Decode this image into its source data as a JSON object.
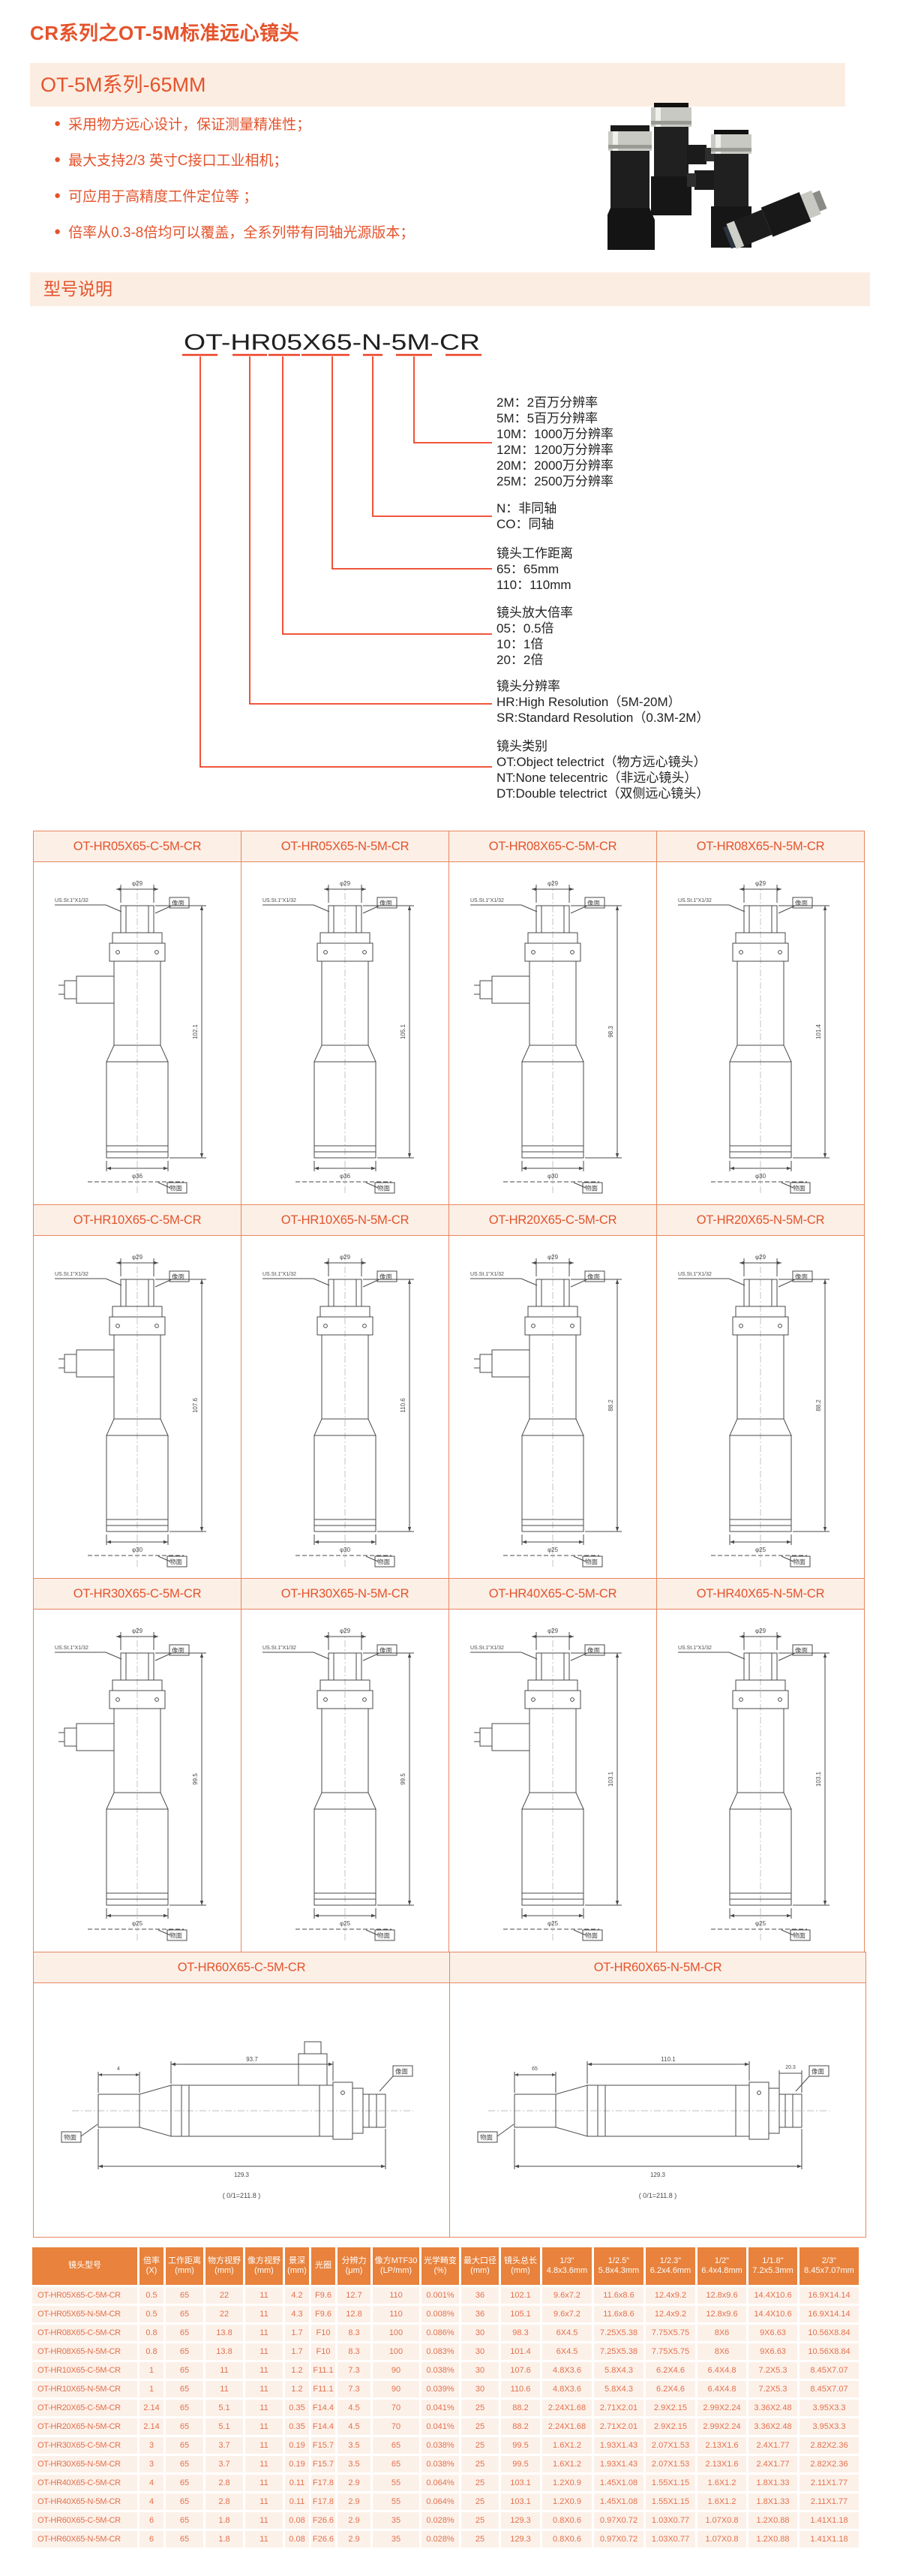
{
  "colors": {
    "accent": "#E4532C",
    "band_bg": "#FCEDE2",
    "callout": "#EE3F22",
    "grid_border": "#E8875F",
    "grid_title_bg": "#FBEFE6",
    "table_header_bg": "#E8823C",
    "table_cell_bg": "#FCF1E9",
    "table_cell_text": "#E2714E",
    "drawing_ink": "#4A4A4A"
  },
  "header": {
    "title": "CR系列之OT-5M标准远心镜头",
    "series_badge": "OT-5M系列-65MM",
    "bullets": [
      "采用物方远心设计，保证测量精准性；",
      "最大支持2/3 英寸C接口工业相机；",
      "可应用于高精度工件定位等 ；",
      "倍率从0.3-8倍均可以覆盖，全系列带有同轴光源版本；"
    ]
  },
  "model_section": {
    "badge": "型号说明",
    "model": "OT-HR05X65-N-5M-CR",
    "groups": [
      {
        "heading": "",
        "lines": [
          "2M：2百万分辨率",
          "5M：5百万分辨率",
          "10M：1000万分辨率",
          "12M：1200万分辨率",
          "20M：2000万分辨率",
          "25M：2500万分辨率"
        ]
      },
      {
        "heading": "",
        "lines": [
          "N：非同轴",
          "CO：同轴"
        ]
      },
      {
        "heading": "镜头工作距离",
        "lines": [
          "65：65mm",
          "110：110mm"
        ]
      },
      {
        "heading": "镜头放大倍率",
        "lines": [
          "05：0.5倍",
          "10：1倍",
          "20：2倍"
        ]
      },
      {
        "heading": "镜头分辨率",
        "lines": [
          "HR:High Resolution（5M-20M）",
          "SR:Standard Resolution（0.3M-2M）"
        ]
      },
      {
        "heading": "镜头类别",
        "lines": [
          "OT:Object telectrict（物方远心镜头）",
          "NT:None telecentric（非远心镜头）",
          "DT:Double telectrict（双侧远心镜头）"
        ]
      }
    ]
  },
  "drawings": {
    "labels": {
      "top_dia": "φ29",
      "thread": "US.St.1\"X1/32",
      "image_plane": "像面",
      "object_plane": "物面"
    },
    "cells": [
      {
        "title": "OT-HR05X65-C-5M-CR",
        "type": "c",
        "dia": "φ36",
        "len": "102.1"
      },
      {
        "title": "OT-HR05X65-N-5M-CR",
        "type": "n",
        "dia": "φ36",
        "len": "105.1"
      },
      {
        "title": "OT-HR08X65-C-5M-CR",
        "type": "c",
        "dia": "φ30",
        "len": "98.3"
      },
      {
        "title": "OT-HR08X65-N-5M-CR",
        "type": "n",
        "dia": "φ30",
        "len": "101.4"
      },
      {
        "title": "OT-HR10X65-C-5M-CR",
        "type": "c",
        "dia": "φ30",
        "len": "107.6"
      },
      {
        "title": "OT-HR10X65-N-5M-CR",
        "type": "n",
        "dia": "φ30",
        "len": "110.6"
      },
      {
        "title": "OT-HR20X65-C-5M-CR",
        "type": "c",
        "dia": "φ25",
        "len": "88.2"
      },
      {
        "title": "OT-HR20X65-N-5M-CR",
        "type": "n",
        "dia": "φ25",
        "len": "88.2"
      },
      {
        "title": "OT-HR30X65-C-5M-CR",
        "type": "c",
        "dia": "φ25",
        "len": "99.5"
      },
      {
        "title": "OT-HR30X65-N-5M-CR",
        "type": "n",
        "dia": "φ25",
        "len": "99.5"
      },
      {
        "title": "OT-HR40X65-C-5M-CR",
        "type": "c",
        "dia": "φ25",
        "len": "103.1"
      },
      {
        "title": "OT-HR40X65-N-5M-CR",
        "type": "n",
        "dia": "φ25",
        "len": "103.1"
      }
    ],
    "wide_cells": [
      {
        "title": "OT-HR60X65-C-5M-CR",
        "type": "c",
        "left": "4",
        "top": "93.7",
        "right": "",
        "len": "129.3",
        "total": "( 0/1=211.8 )"
      },
      {
        "title": "OT-HR60X65-N-5M-CR",
        "type": "n",
        "left": "65",
        "top": "110.1",
        "right": "20.3",
        "len": "129.3",
        "total": "( 0/1=211.8 )"
      }
    ]
  },
  "table": {
    "headers": [
      "镜头型号",
      "倍率\n(X)",
      "工作距离\n(mm)",
      "物方视野\n(mm)",
      "像方视野\n(mm)",
      "景深\n(mm)",
      "光圈",
      "分辨力\n(μm)",
      "像方MTF30\n(LP/mm)",
      "光学畸变\n(%)",
      "最大口径\n(mm)",
      "镜头总长\n(mm)",
      "1/3\"\n4.8x3.6mm",
      "1/2.5\"\n5.8x4.3mm",
      "1/2.3\"\n6.2x4.6mm",
      "1/2\"\n6.4x4.8mm",
      "1/1.8\"\n7.2x5.3mm",
      "2/3\"\n8.45x7.07mm"
    ],
    "rows": [
      [
        "OT-HR05X65-C-5M-CR",
        "0.5",
        "65",
        "22",
        "11",
        "4.2",
        "F9.6",
        "12.7",
        "110",
        "0.001%",
        "36",
        "102.1",
        "9.6x7.2",
        "11.6x8.6",
        "12.4x9.2",
        "12.8x9.6",
        "14.4X10.6",
        "16.9X14.14"
      ],
      [
        "OT-HR05X65-N-5M-CR",
        "0.5",
        "65",
        "22",
        "11",
        "4.3",
        "F9.6",
        "12.8",
        "110",
        "0.008%",
        "36",
        "105.1",
        "9.6x7.2",
        "11.6x8.6",
        "12.4x9.2",
        "12.8x9.6",
        "14.4X10.6",
        "16.9X14.14"
      ],
      [
        "OT-HR08X65-C-5M-CR",
        "0.8",
        "65",
        "13.8",
        "11",
        "1.7",
        "F10",
        "8.3",
        "100",
        "0.086%",
        "30",
        "98.3",
        "6X4.5",
        "7.25X5.38",
        "7.75X5.75",
        "8X6",
        "9X6.63",
        "10.56X8.84"
      ],
      [
        "OT-HR08X65-N-5M-CR",
        "0.8",
        "65",
        "13.8",
        "11",
        "1.7",
        "F10",
        "8.3",
        "100",
        "0.083%",
        "30",
        "101.4",
        "6X4.5",
        "7.25X5.38",
        "7.75X5.75",
        "8X6",
        "9X6.63",
        "10.56X8.84"
      ],
      [
        "OT-HR10X65-C-5M-CR",
        "1",
        "65",
        "11",
        "11",
        "1.2",
        "F11.1",
        "7.3",
        "90",
        "0.038%",
        "30",
        "107.6",
        "4.8X3.6",
        "5.8X4.3",
        "6.2X4.6",
        "6.4X4.8",
        "7.2X5.3",
        "8.45X7.07"
      ],
      [
        "OT-HR10X65-N-5M-CR",
        "1",
        "65",
        "11",
        "11",
        "1.2",
        "F11.1",
        "7.3",
        "90",
        "0.039%",
        "30",
        "110.6",
        "4.8X3.6",
        "5.8X4.3",
        "6.2X4.6",
        "6.4X4.8",
        "7.2X5.3",
        "8.45X7.07"
      ],
      [
        "OT-HR20X65-C-5M-CR",
        "2.14",
        "65",
        "5.1",
        "11",
        "0.35",
        "F14.4",
        "4.5",
        "70",
        "0.041%",
        "25",
        "88.2",
        "2.24X1.68",
        "2.71X2.01",
        "2.9X2.15",
        "2.99X2.24",
        "3.36X2.48",
        "3.95X3.3"
      ],
      [
        "OT-HR20X65-N-5M-CR",
        "2.14",
        "65",
        "5.1",
        "11",
        "0.35",
        "F14.4",
        "4.5",
        "70",
        "0.041%",
        "25",
        "88.2",
        "2.24X1.68",
        "2.71X2.01",
        "2.9X2.15",
        "2.99X2.24",
        "3.36X2.48",
        "3.95X3.3"
      ],
      [
        "OT-HR30X65-C-5M-CR",
        "3",
        "65",
        "3.7",
        "11",
        "0.19",
        "F15.7",
        "3.5",
        "65",
        "0.038%",
        "25",
        "99.5",
        "1.6X1.2",
        "1.93X1.43",
        "2.07X1.53",
        "2.13X1.6",
        "2.4X1.77",
        "2.82X2.36"
      ],
      [
        "OT-HR30X65-N-5M-CR",
        "3",
        "65",
        "3.7",
        "11",
        "0.19",
        "F15.7",
        "3.5",
        "65",
        "0.038%",
        "25",
        "99.5",
        "1.6X1.2",
        "1.93X1.43",
        "2.07X1.53",
        "2.13X1.6",
        "2.4X1.77",
        "2.82X2.36"
      ],
      [
        "OT-HR40X65-C-5M-CR",
        "4",
        "65",
        "2.8",
        "11",
        "0.11",
        "F17.8",
        "2.9",
        "55",
        "0.064%",
        "25",
        "103.1",
        "1.2X0.9",
        "1.45X1.08",
        "1.55X1.15",
        "1.6X1.2",
        "1.8X1.33",
        "2.11X1.77"
      ],
      [
        "OT-HR40X65-N-5M-CR",
        "4",
        "65",
        "2.8",
        "11",
        "0.11",
        "F17.8",
        "2.9",
        "55",
        "0.064%",
        "25",
        "103.1",
        "1.2X0.9",
        "1.45X1.08",
        "1.55X1.15",
        "1.6X1.2",
        "1.8X1.33",
        "2.11X1.77"
      ],
      [
        "OT-HR60X65-C-5M-CR",
        "6",
        "65",
        "1.8",
        "11",
        "0.08",
        "F26.6",
        "2.9",
        "35",
        "0.028%",
        "25",
        "129.3",
        "0.8X0.6",
        "0.97X0.72",
        "1.03X0.77",
        "1.07X0.8",
        "1.2X0.88",
        "1.41X1.18"
      ],
      [
        "OT-HR60X65-N-5M-CR",
        "6",
        "65",
        "1.8",
        "11",
        "0.08",
        "F26.6",
        "2.9",
        "35",
        "0.028%",
        "25",
        "129.3",
        "0.8X0.6",
        "0.97X0.72",
        "1.03X0.77",
        "1.07X0.8",
        "1.2X0.88",
        "1.41X1.18"
      ]
    ]
  }
}
